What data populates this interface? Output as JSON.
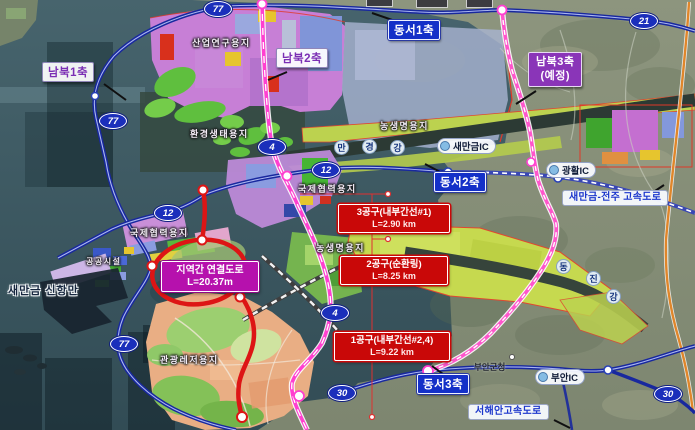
{
  "colors": {
    "sea": "#3c5a63",
    "land": "#87907a",
    "axis_blue": "#1430c8",
    "axis_purple": "#7b2fb4",
    "route_shield_blue": "#1b2fbb",
    "construction_red": "#c90808",
    "connector_magenta": "#b611ad",
    "road_pink": "#ff3fd0",
    "road_red": "#dd1515",
    "road_blue": "#18289e",
    "road_orange": "#e0862a"
  },
  "axes": {
    "nambuk1": {
      "label": "남북1축"
    },
    "nambuk2": {
      "label": "남북2축"
    },
    "nambuk3": {
      "label": "남북3축",
      "sub": "(예정)"
    },
    "dongseo1": {
      "label": "동서1축"
    },
    "dongseo2": {
      "label": "동서2축"
    },
    "dongseo3": {
      "label": "동서3축"
    }
  },
  "routes": {
    "r77": "77",
    "r21": "21",
    "r4": "4",
    "r12": "12",
    "r30": "30"
  },
  "interchanges": {
    "saemangeum": "새만금IC",
    "gwanghwal": "광활IC",
    "buan": "부안IC"
  },
  "expressways": {
    "saemangeum_jeonju": "새만금-전주 고속도로",
    "seohaean": "서해안고속도로"
  },
  "construction_sections": [
    {
      "name": "3공구(내부간선#1)",
      "length": "L=2.90 km"
    },
    {
      "name": "2공구(순환링)",
      "length": "L=8.25 km"
    },
    {
      "name": "1공구(내부간선#2,4)",
      "length": "L=9.22 km"
    }
  ],
  "regional_connector": {
    "name": "지역간 연결도로",
    "length": "L=20.37m"
  },
  "zones": {
    "industry": "산업연구용지",
    "eco": "환경생태용지",
    "agri_north": "농생명용지",
    "intl_mid": "국제협력용지",
    "intl_west": "국제협력용지",
    "agri_mid": "농생명용지",
    "tourism": "관광레저용지",
    "public": "공공시설"
  },
  "places": {
    "new_port": "새만금 신항만",
    "buan_office": "부안군청"
  },
  "rivers": {
    "mangyeong": [
      "만",
      "경",
      "강"
    ],
    "dongjin": [
      "동",
      "진",
      "강"
    ]
  }
}
